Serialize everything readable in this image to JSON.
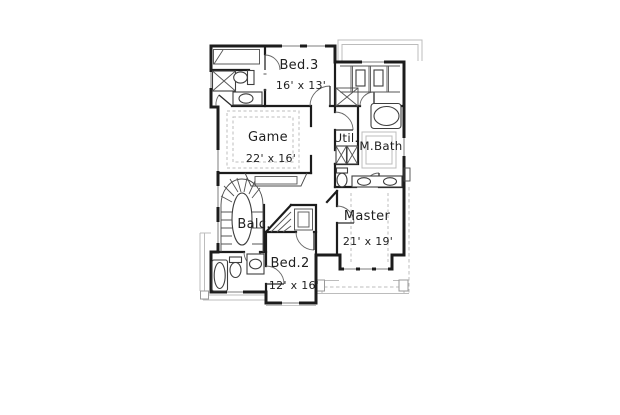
{
  "canvas": {
    "width": 620,
    "height": 415,
    "background": "#ffffff"
  },
  "plan": {
    "type": "floor-plan-drawing",
    "colors": {
      "wall": "#1c1c1c",
      "fixture_line": "#4a4a4a",
      "light_line": "#bcbcbc",
      "label_text": "#1f1f1f"
    },
    "rooms": [
      {
        "id": "bed3",
        "name": "Bed.3",
        "dims": "16' x 13'"
      },
      {
        "id": "game",
        "name": "Game",
        "dims": "22' x 16'"
      },
      {
        "id": "util",
        "name": "Util.",
        "dims": ""
      },
      {
        "id": "mbath",
        "name": "M.Bath",
        "dims": ""
      },
      {
        "id": "balc",
        "name": "Balc.",
        "dims": ""
      },
      {
        "id": "master",
        "name": "Master",
        "dims": "21' x 19'"
      },
      {
        "id": "bed2",
        "name": "Bed.2",
        "dims": "12' x 16'"
      }
    ]
  }
}
